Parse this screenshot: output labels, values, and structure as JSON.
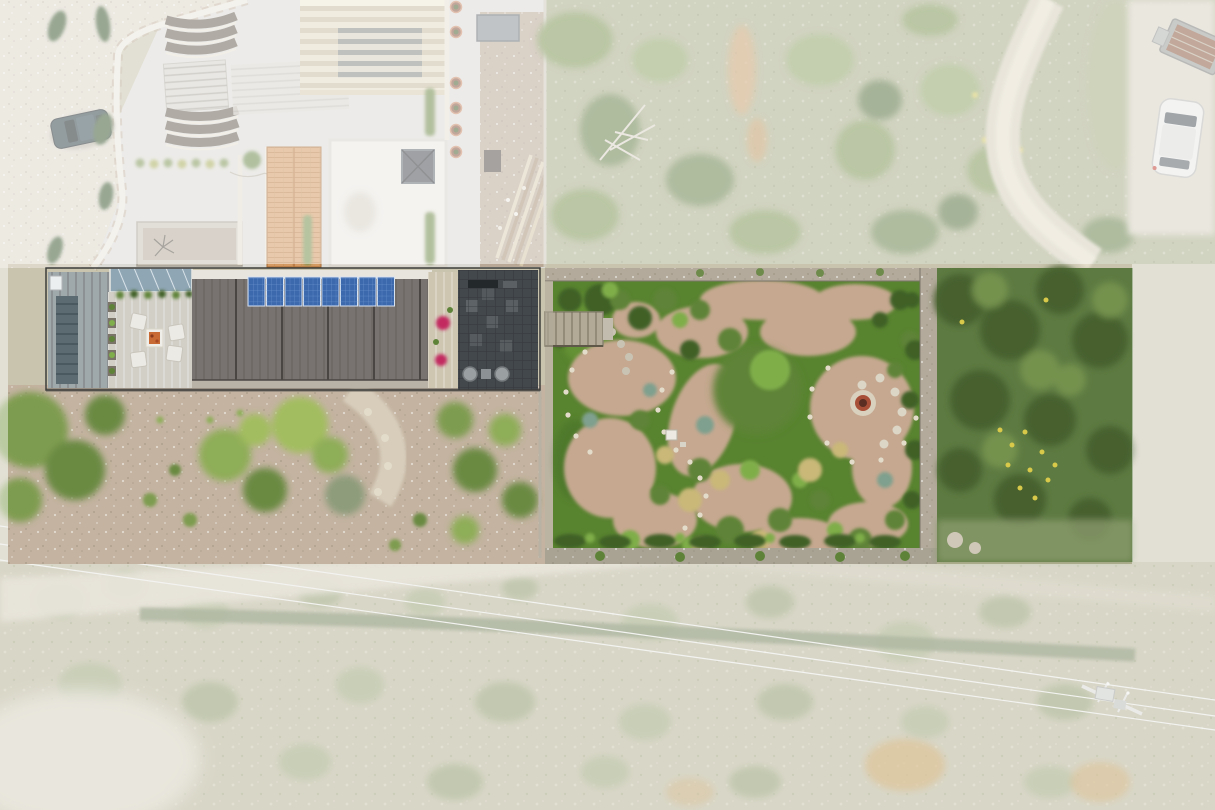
{
  "meta": {
    "type": "aerial-drone-photograph",
    "view": "top-down (nadir)",
    "width_px": 1215,
    "height_px": 810
  },
  "scene": {
    "description": "Top-down aerial photo of a long modern flat-roofed house with rooftop solar panels and a walled landscaped garden. The property lot is shown at full colour saturation while all surrounding land is faded under a translucent white overlay (real-estate lot highlight).",
    "highlight": {
      "style": "translucent white wash outside the lot boundary",
      "lot_bounds_px": {
        "x": 8,
        "y": 264,
        "width": 1124,
        "height": 300
      }
    },
    "areas": [
      {
        "name": "upper-left-courtyard-complex",
        "label": "Paved courtyard with curved retaining wall, terraced planting beds, staircases, cypress trees and a parked dark SUV"
      },
      {
        "name": "pergola-roof-building",
        "label": "Building with slatted pergola roof, flat roof with pyramid skylight, and terracotta-tiled roof section"
      },
      {
        "name": "construction-yard",
        "label": "Side yard with stacked lumber and building materials"
      },
      {
        "name": "upper-scrub-field",
        "label": "Faded scrubland with orange and yellow flowering patches, a fallen tree and a dirt footpath"
      },
      {
        "name": "parking-area",
        "label": "Gravel parking patch with a white car and a rusty flatbed trailer"
      },
      {
        "name": "modern-house",
        "label": "Long modern house: standing-seam metal roof, glass skylight strip, timber deck with white lounge furniture, dark ribbed main roof with solar array, rear dark pergola patio with bougainvillea"
      },
      {
        "name": "front-yard",
        "label": "Gravel yard with scattered green trees and shrubs south of the house"
      },
      {
        "name": "walled-garden",
        "label": "Stone-walled garden with winding pink gravel paths edged in white stones, lawn, mixed shrub beds, wooden stairs, a small white table and a circular fire-pit patio"
      },
      {
        "name": "rear-thicket",
        "label": "Dense saturated green thicket with yellow wildflowers at the east end of the lot"
      },
      {
        "name": "lower-scrub-field",
        "label": "Faded scrub with a pale dirt track, a dark hedge row, power lines and a utility pole"
      }
    ],
    "objects": [
      {
        "name": "solar-panel-array",
        "count": 8
      },
      {
        "name": "lounge-chairs",
        "count": 4
      },
      {
        "name": "deck-table",
        "count": 1
      },
      {
        "name": "bougainvillea-pots",
        "count": 2
      },
      {
        "name": "patio-round-tables",
        "count": 2
      },
      {
        "name": "round-planter-pots",
        "count": 6
      },
      {
        "name": "fire-pit",
        "count": 1
      },
      {
        "name": "garden-wood-stairs",
        "count": 1
      },
      {
        "name": "parked-suv-dark",
        "count": 1
      },
      {
        "name": "parked-car-white",
        "count": 1
      },
      {
        "name": "flatbed-trailer",
        "count": 1
      },
      {
        "name": "utility-pole",
        "count": 1
      },
      {
        "name": "power-lines",
        "count": 3
      }
    ]
  },
  "palette": {
    "mask": "#ffffff",
    "mask_opacity": "0.47",
    "pavement": "#dcdad5",
    "gravel_left": "#ddd7c9",
    "scrub_top": "#a9ae8a",
    "lower_scrub": "#b6b295",
    "yard_gravel": "#c3b3a0",
    "lawn": "#58832f",
    "garden_gravel": "#c6a890",
    "rear_veg": "#5d7a42",
    "wall_stone": "#b3aa9b",
    "roof_main": "#787270",
    "roof_metal": "#9fa9ac",
    "deck_wood": "#d2cfc7",
    "pergola_dark": "#43484c",
    "solar_blue": "#3c69ae",
    "terracotta": "#d49a62",
    "soil_bed": "#6b6155",
    "car_dark": "#33454a",
    "car_white": "#e9e9e7",
    "trailer_bed": "#8a5b41",
    "flower_magenta": "#c22960",
    "firepit_ring": "#a84f38",
    "road_dirt": "#d6cfbc",
    "hedge": "#6b7a52",
    "wire": "#e8e8e4",
    "pole": "#d8d8d4"
  }
}
